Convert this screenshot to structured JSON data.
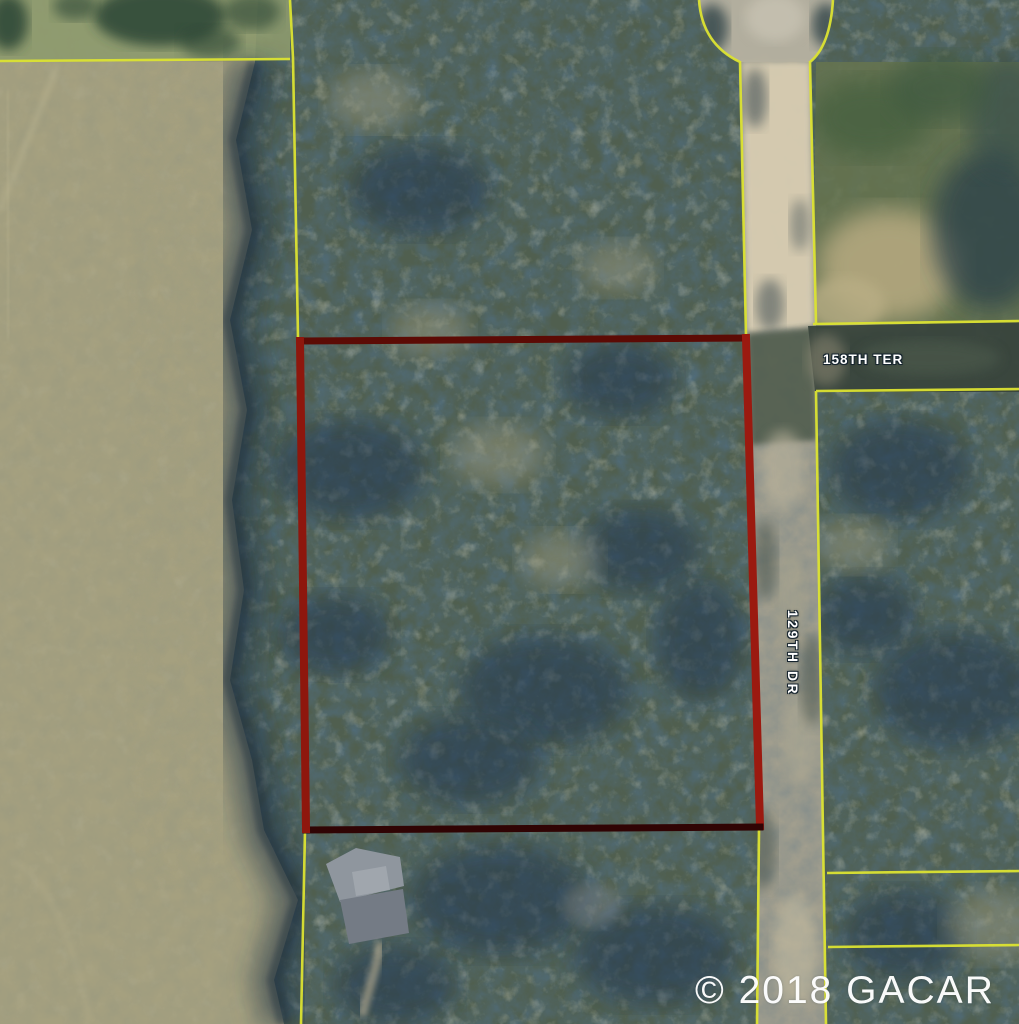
{
  "map": {
    "description": "Aerial parcel map with subject parcel outlined in red",
    "streets": [
      {
        "name": "158TH TER",
        "orientation": "horizontal"
      },
      {
        "name": "129TH DR",
        "orientation": "vertical"
      }
    ],
    "watermark": "© 2018 GACAR",
    "colors": {
      "subject_parcel_outline": "#9b1a10",
      "parcel_boundary_lines": "#dce332",
      "street_label_text": "#ffffff",
      "watermark_text": "#ffffff"
    }
  }
}
